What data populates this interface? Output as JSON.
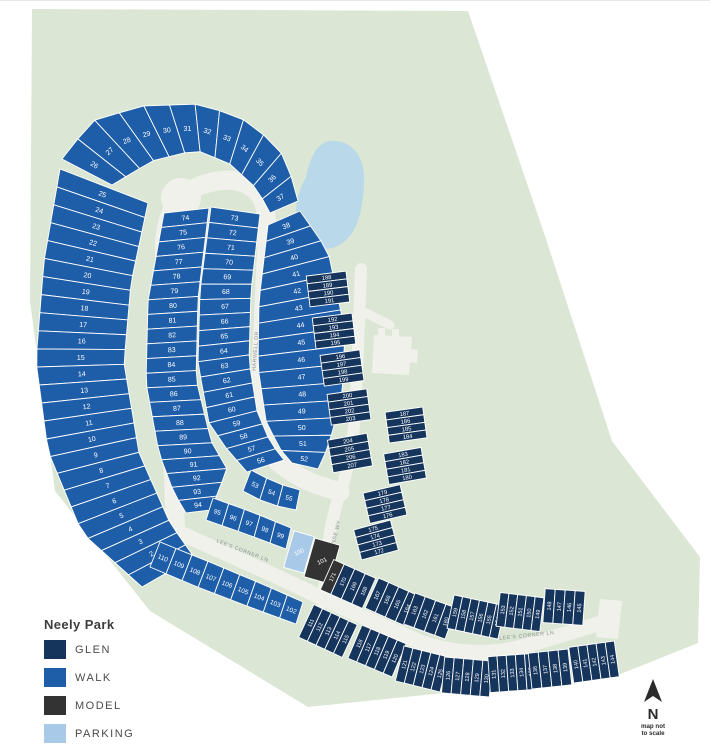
{
  "legend": {
    "title": "Neely Park",
    "items": [
      {
        "label": "GLEN",
        "color": "#16355D"
      },
      {
        "label": "WALK",
        "color": "#1E5DA8"
      },
      {
        "label": "MODEL",
        "color": "#333333"
      },
      {
        "label": "PARKING",
        "color": "#A9C9E8"
      }
    ]
  },
  "compass": {
    "label": "N",
    "note_lines": [
      "map not",
      "to scale"
    ]
  },
  "colors": {
    "site_green": "#dbe7d4",
    "road": "#f1f1ec",
    "pond": "#b9d8e9",
    "street_label": "#8c9196"
  },
  "streets": [
    {
      "name": "HARWELL DR"
    },
    {
      "name": "HARWELL DR"
    },
    {
      "name": "LEE'S CORNER LN"
    },
    {
      "name": "LEE'S CORNER LN"
    },
    {
      "name": "PLANE SENSE WY"
    }
  ],
  "special_lots": {
    "100": "PARKING",
    "101": "MODEL",
    "171": "MODEL"
  },
  "groups": [
    {
      "id": "col-left",
      "category": "WALK",
      "lots": [
        25,
        24,
        23,
        22,
        21,
        20,
        19,
        18,
        17,
        16,
        15,
        14,
        13,
        12,
        11,
        10,
        9,
        8,
        7,
        6,
        5,
        4,
        3,
        2,
        1
      ]
    },
    {
      "id": "arc-top",
      "category": "WALK",
      "lots": [
        26,
        27,
        28,
        29,
        30,
        31,
        32,
        33,
        34,
        35,
        36,
        37
      ]
    },
    {
      "id": "col-outer-right",
      "category": "WALK",
      "lots": [
        38,
        39,
        40,
        41,
        42,
        43,
        44,
        45,
        46,
        47,
        48,
        49,
        50,
        51,
        52
      ]
    },
    {
      "id": "fan-south",
      "category": "WALK",
      "lots": [
        53,
        54,
        55
      ]
    },
    {
      "id": "col-inner-right",
      "category": "WALK",
      "lots": [
        73,
        72,
        71,
        70,
        69,
        68,
        67,
        66,
        65,
        64,
        63,
        62,
        61,
        60,
        59,
        58,
        57,
        56
      ]
    },
    {
      "id": "col-inner-left",
      "category": "WALK",
      "lots": [
        74,
        75,
        76,
        77,
        78,
        79,
        80,
        81,
        82,
        83,
        84,
        85,
        86,
        87,
        88,
        89,
        90,
        91,
        92,
        93,
        94
      ]
    },
    {
      "id": "row-south-mid",
      "category": "WALK",
      "lots": [
        95,
        96,
        97,
        98,
        99
      ]
    },
    {
      "id": "row-lee-west",
      "category": "WALK",
      "lots": [
        110,
        109,
        108,
        107,
        106,
        105,
        104,
        103,
        102
      ]
    },
    {
      "id": "parking-100",
      "category": "PARKING",
      "lots": [
        100
      ]
    },
    {
      "id": "model-101",
      "category": "MODEL",
      "lots": [
        101
      ]
    },
    {
      "id": "g188",
      "category": "GLEN",
      "lots": [
        188,
        189,
        190,
        191
      ]
    },
    {
      "id": "g192",
      "category": "GLEN",
      "lots": [
        192,
        193,
        194,
        195
      ]
    },
    {
      "id": "g196",
      "category": "GLEN",
      "lots": [
        196,
        197,
        198,
        199
      ]
    },
    {
      "id": "g200",
      "category": "GLEN",
      "lots": [
        200,
        201,
        202,
        203
      ]
    },
    {
      "id": "g204",
      "category": "GLEN",
      "lots": [
        204,
        205,
        206,
        207
      ]
    },
    {
      "id": "g187",
      "category": "GLEN",
      "lots": [
        187,
        186,
        185,
        184
      ]
    },
    {
      "id": "g183",
      "category": "GLEN",
      "lots": [
        183,
        182,
        181,
        180
      ]
    },
    {
      "id": "g179",
      "category": "GLEN",
      "lots": [
        179,
        178,
        177,
        176
      ]
    },
    {
      "id": "g175",
      "category": "GLEN",
      "lots": [
        175,
        174,
        173,
        172
      ]
    },
    {
      "id": "tA",
      "category": "GLEN",
      "lots": [
        171,
        170,
        169,
        168
      ]
    },
    {
      "id": "tB",
      "category": "GLEN",
      "lots": [
        167,
        166,
        165,
        164
      ]
    },
    {
      "id": "tC",
      "category": "GLEN",
      "lots": [
        163,
        162,
        161,
        160
      ]
    },
    {
      "id": "tD",
      "category": "GLEN",
      "lots": [
        159,
        158,
        157,
        156,
        155,
        154
      ]
    },
    {
      "id": "tE",
      "category": "GLEN",
      "lots": [
        153,
        152,
        151,
        150,
        149
      ]
    },
    {
      "id": "tF",
      "category": "GLEN",
      "lots": [
        148,
        147,
        146,
        145
      ]
    },
    {
      "id": "tG",
      "category": "GLEN",
      "lots": [
        111,
        112,
        113,
        114,
        115
      ]
    },
    {
      "id": "tH",
      "category": "GLEN",
      "lots": [
        116,
        117,
        118,
        119,
        120
      ]
    },
    {
      "id": "tI",
      "category": "GLEN",
      "lots": [
        121,
        122,
        123,
        124,
        125
      ]
    },
    {
      "id": "tJ",
      "category": "GLEN",
      "lots": [
        126,
        127,
        128,
        129,
        130
      ]
    },
    {
      "id": "tK",
      "category": "GLEN",
      "lots": [
        131,
        132,
        133,
        134,
        135
      ]
    },
    {
      "id": "tL",
      "category": "GLEN",
      "lots": [
        136,
        137,
        138,
        139
      ]
    },
    {
      "id": "tM",
      "category": "GLEN",
      "lots": [
        140,
        141,
        142,
        143,
        144
      ]
    }
  ]
}
